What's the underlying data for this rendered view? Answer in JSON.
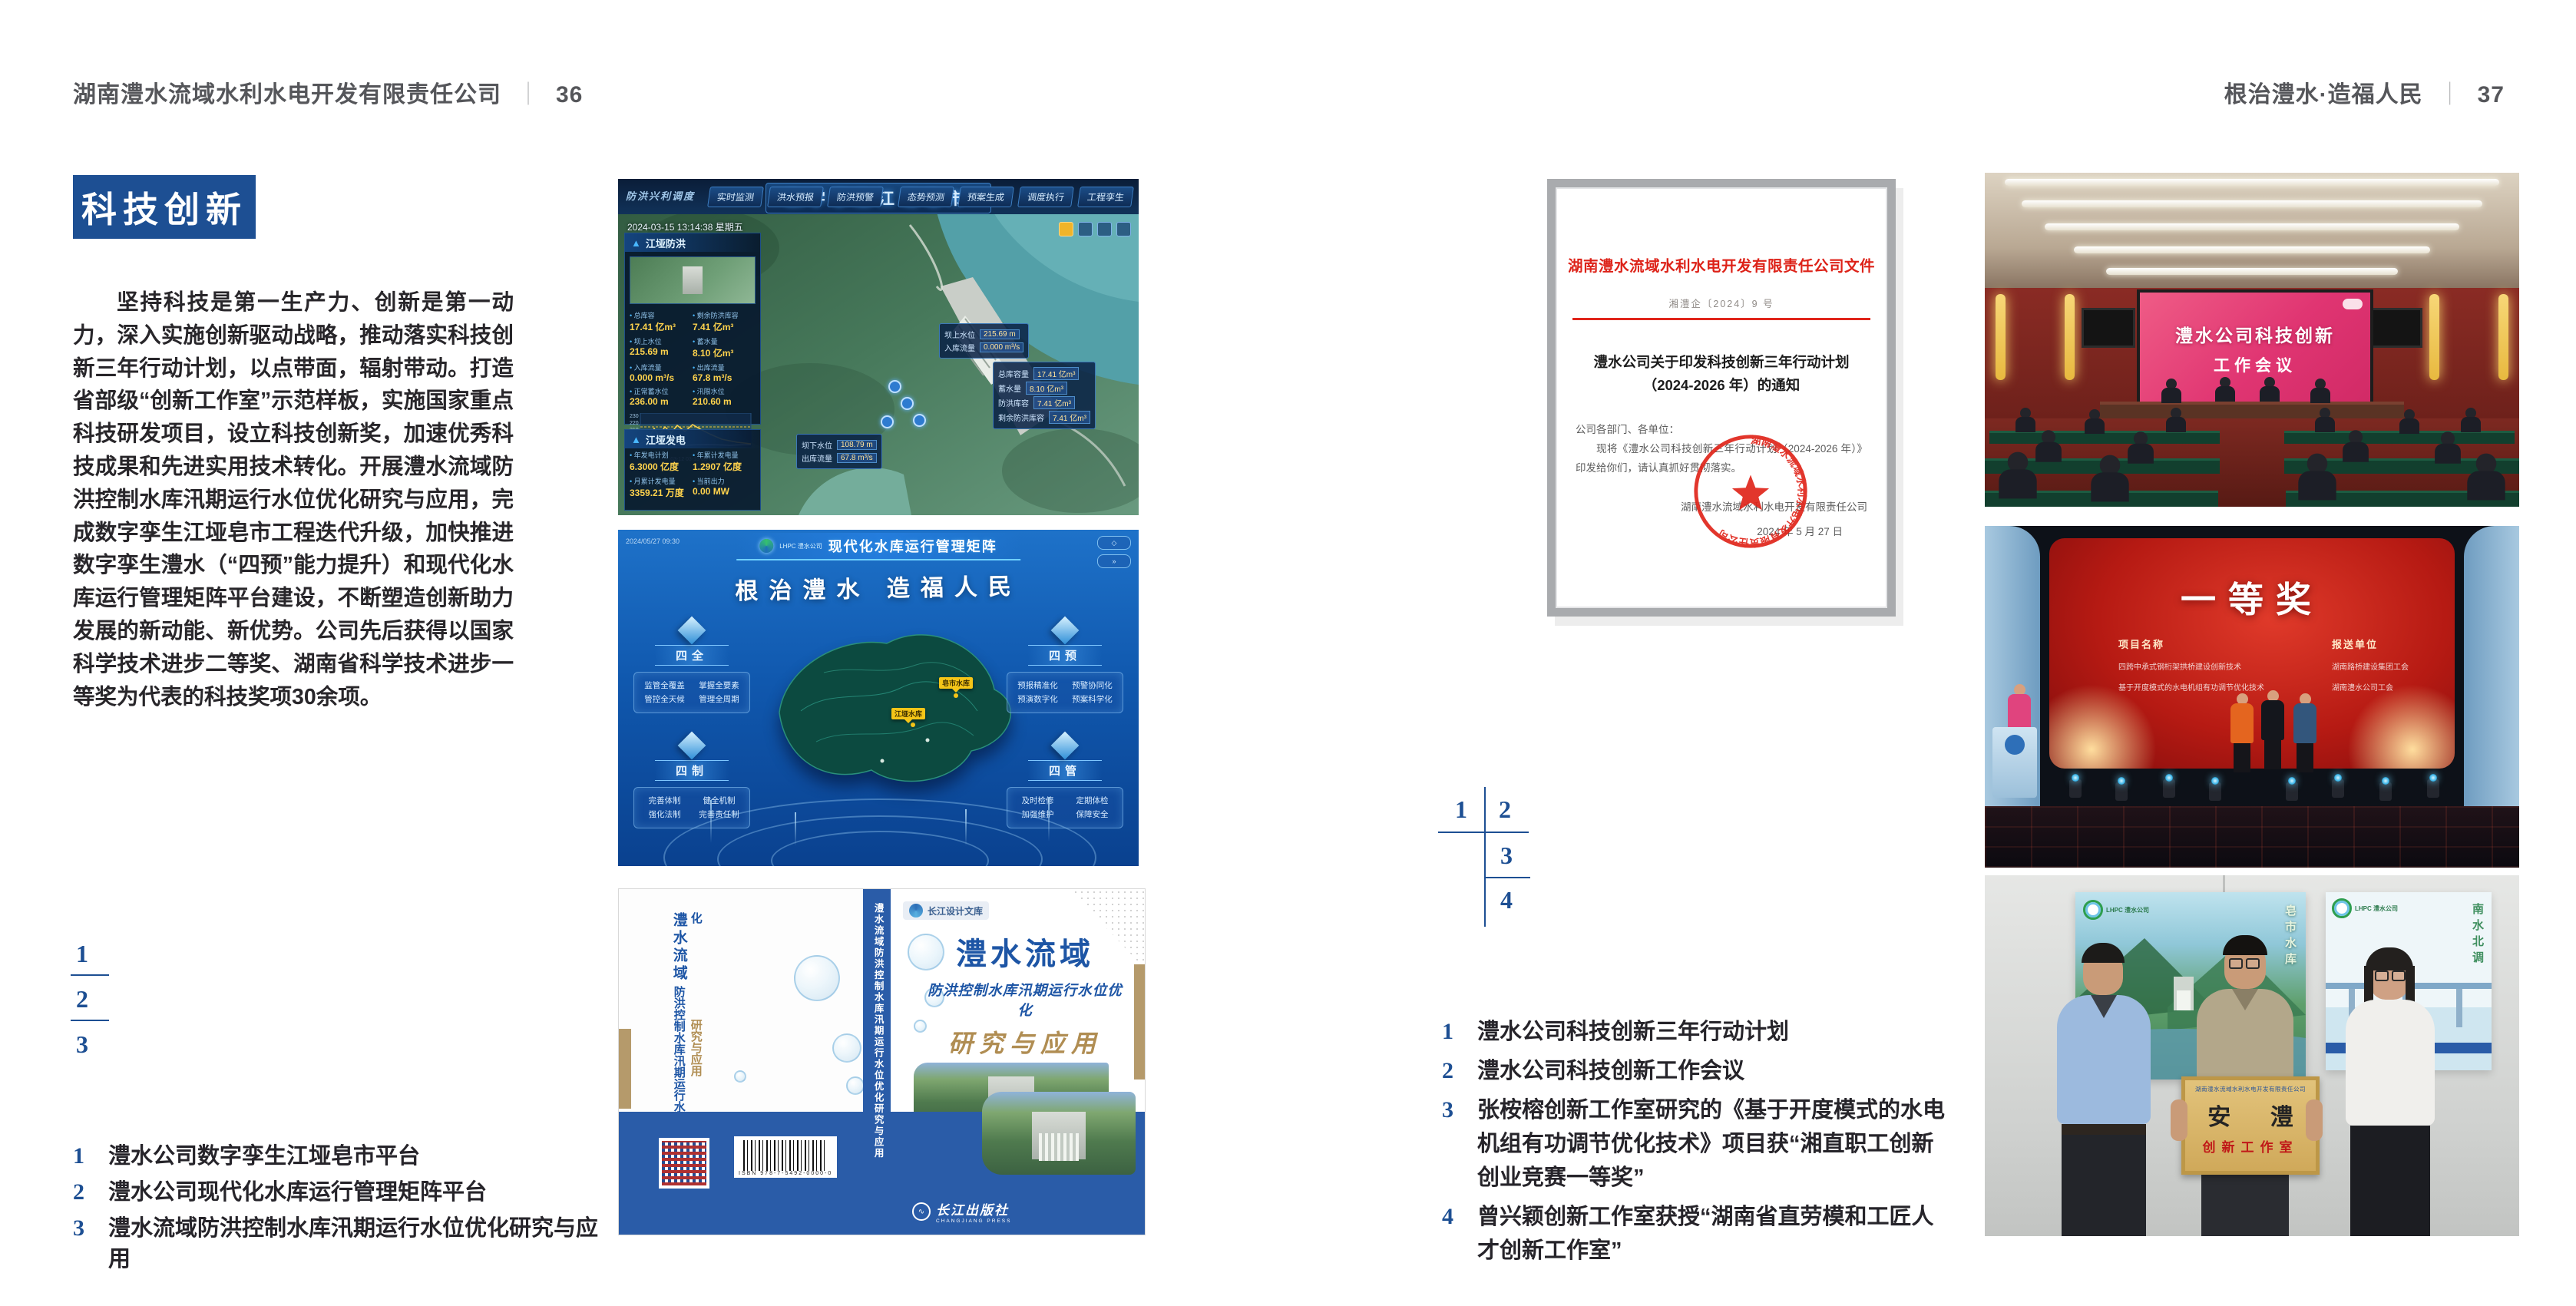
{
  "colors": {
    "accent_blue": "#1d4f93",
    "document_red": "#dd2218",
    "book_blue": "#2a5ca8",
    "tan": "#b59a6b",
    "header_gray": "#55565a"
  },
  "left_page": {
    "header": {
      "company": "湖南澧水流域水利水电开发有限责任公司",
      "separator": "｜",
      "page_number": "36"
    },
    "section_title": "科技创新",
    "body_text": "坚持科技是第一生产力、创新是第一动力，深入实施创新驱动战略，推动落实科技创新三年行动计划，以点带面，辐射带动。打造省部级“创新工作室”示范样板，实施国家重点科技研发项目，设立科技创新奖，加速优秀科技成果和先进实用技术转化。开展澧水流域防洪控制水库汛期运行水位优化研究与应用，完成数字孪生江垭皂市工程迭代升级，加快推进数字孪生澧水（“四预”能力提升）和现代化水库运行管理矩阵平台建设，不断塑造创新助力发展的新动能、新优势。公司先后获得以国家科学技术进步二等奖、湖南省科学技术进步一等奖为代表的科技奖项30余项。",
    "figure_index": {
      "n1": "1",
      "n2": "2",
      "n3": "3"
    },
    "captions": [
      {
        "num": "1",
        "text": "澧水公司数字孪生江垭皂市平台"
      },
      {
        "num": "2",
        "text": "澧水公司现代化水库运行管理矩阵平台"
      },
      {
        "num": "3",
        "text": "澧水流域防洪控制水库汛期运行水位优化研究与应用"
      }
    ]
  },
  "right_page": {
    "header": {
      "slogan": "根治澧水·造福人民",
      "separator": "｜",
      "page_number": "37"
    },
    "figure_index": {
      "n1": "1",
      "n2": "2",
      "n3": "3",
      "n4": "4"
    },
    "captions": [
      {
        "num": "1",
        "text": "澧水公司科技创新三年行动计划"
      },
      {
        "num": "2",
        "text": "澧水公司科技创新工作会议"
      },
      {
        "num": "3",
        "text": "张桉榕创新工作室研究的《基于开度模式的水电机组有功调节优化技术》项目获“湘直职工创新创业竞赛一等奖”"
      },
      {
        "num": "4",
        "text": "曾兴颖创新工作室获授“湖南省直劳模和工匠人才创新工作室”"
      }
    ]
  },
  "document": {
    "header": "湖南澧水流域水利水电开发有限责任公司文件",
    "doc_number": "湘澧企〔2024〕9 号",
    "title_line1": "澧水公司关于印发科技创新三年行动计划",
    "title_line2": "（2024-2026 年）的通知",
    "salutation": "公司各部门、各单位：",
    "body": "现将《澧水公司科技创新三年行动计划（2024-2026 年）》印发给你们，请认真抓好贯彻落实。",
    "signer": "湖南澧水流域水利水电开发有限责任公司",
    "date": "2024 年 5 月 27 日",
    "seal_text": "湖南澧水流域水利水电开发有限责任公司"
  },
  "fig_dashboard": {
    "corner_label": "防洪兴利调度",
    "title": "数字孪生江垭皂市",
    "datetime": "2024-03-15 13:14:38 星期五",
    "tabs_left": [
      "实时监测",
      "洪水预报",
      "防洪预警"
    ],
    "tabs_right": [
      "态势预测",
      "预案生成",
      "调度执行",
      "工程孪生"
    ],
    "panel1_title": "江垭防洪",
    "panel1_stats": [
      [
        "总库容",
        "17.41 亿m³"
      ],
      [
        "剩余防洪库容",
        "7.41 亿m³"
      ],
      [
        "坝上水位",
        "215.69 m"
      ],
      [
        "蓄水量",
        "8.10 亿m³"
      ],
      [
        "入库流量",
        "0.000 m³/s"
      ],
      [
        "出库流量",
        "67.8 m³/s"
      ],
      [
        "正常蓄水位",
        "236.00 m"
      ],
      [
        "汛限水位",
        "210.60 m"
      ]
    ],
    "chart_y_labels": "230\n220\n210\n200\n190",
    "chart_x_labels": "03-12  03-13  03-14",
    "panel2_title": "江垭发电",
    "panel2_stats": [
      [
        "年发电计划",
        "6.3000 亿度"
      ],
      [
        "年累计发电量",
        "1.2907 亿度"
      ],
      [
        "月累计发电量",
        "3359.21 万度"
      ],
      [
        "当前出力",
        "0.00 MW"
      ]
    ],
    "callout1": [
      [
        "坝上水位",
        "215.69 m"
      ],
      [
        "入库流量",
        "0.000 m³/s"
      ]
    ],
    "callout2": [
      [
        "坝下水位",
        "108.79 m"
      ],
      [
        "出库流量",
        "67.8 m³/s"
      ]
    ],
    "callout3": [
      [
        "总库容量",
        "17.41 亿m³"
      ],
      [
        "蓄水量",
        "8.10 亿m³"
      ],
      [
        "防洪库容",
        "7.41 亿m³"
      ],
      [
        "剩余防洪库容",
        "7.41 亿m³"
      ]
    ]
  },
  "fig_matrix": {
    "logo_text": "LHPC 澧水公司",
    "title": "现代化水库运行管理矩阵",
    "slogan": "根治澧水 造福人民",
    "groups": [
      {
        "name": "四全",
        "items": [
          "监管全覆盖",
          "掌握全要素",
          "管控全天候",
          "管理全周期"
        ]
      },
      {
        "name": "四预",
        "items": [
          "预报精准化",
          "预警协同化",
          "预演数字化",
          "预案科学化"
        ]
      },
      {
        "name": "四制",
        "items": [
          "完善体制",
          "健全机制",
          "强化法制",
          "完善责任制"
        ]
      },
      {
        "name": "四管",
        "items": [
          "及时检修",
          "定期体检",
          "加强维护",
          "保障安全"
        ]
      }
    ],
    "markers": [
      "皂市水库",
      "江垭水库"
    ]
  },
  "fig_book": {
    "series_badge": "长江设计文库",
    "title": "澧水流域",
    "subtitle": "防洪控制水库汛期运行水位优化",
    "title2": "研究与应用",
    "authors": "洪兴骏  沈坤民  鲁军  刘世军  等著",
    "spine_text": "澧水流域防洪控制水库汛期运行水位优化研究与应用",
    "publisher": "长江出版社",
    "publisher_en": "CHANGJIANG PRESS",
    "back_title_1": "澧水流域",
    "back_title_2": "防洪控制水库汛期运行水位优化",
    "back_title_3": "研究与应用",
    "barcode_caption": "ISBN 978-7-5492-0000-0"
  },
  "fig_meeting": {
    "screen_line1": "澧水公司科技创新",
    "screen_line2": "工作会议"
  },
  "fig_award": {
    "screen_title": "一等奖",
    "col1_header": "项目名称",
    "col2_header": "报送单位",
    "rows": [
      {
        "project": "四跨中承式钢桁架拱桥建设创新技术",
        "org": "湖南路桥建设集团工会"
      },
      {
        "project": "基于开度模式的水电机组有功调节优化技术",
        "org": "湖南澧水公司工会"
      }
    ]
  },
  "fig_workshop": {
    "plaque_header": "湖南澧水流域水利水电开发有限责任公司",
    "plaque_title": "安 澧",
    "plaque_subtitle": "创新工作室",
    "poster_left_vtext": "皂市水库",
    "poster_right_vtext": "南水北调",
    "logo_text": "LHPC 澧水公司"
  }
}
